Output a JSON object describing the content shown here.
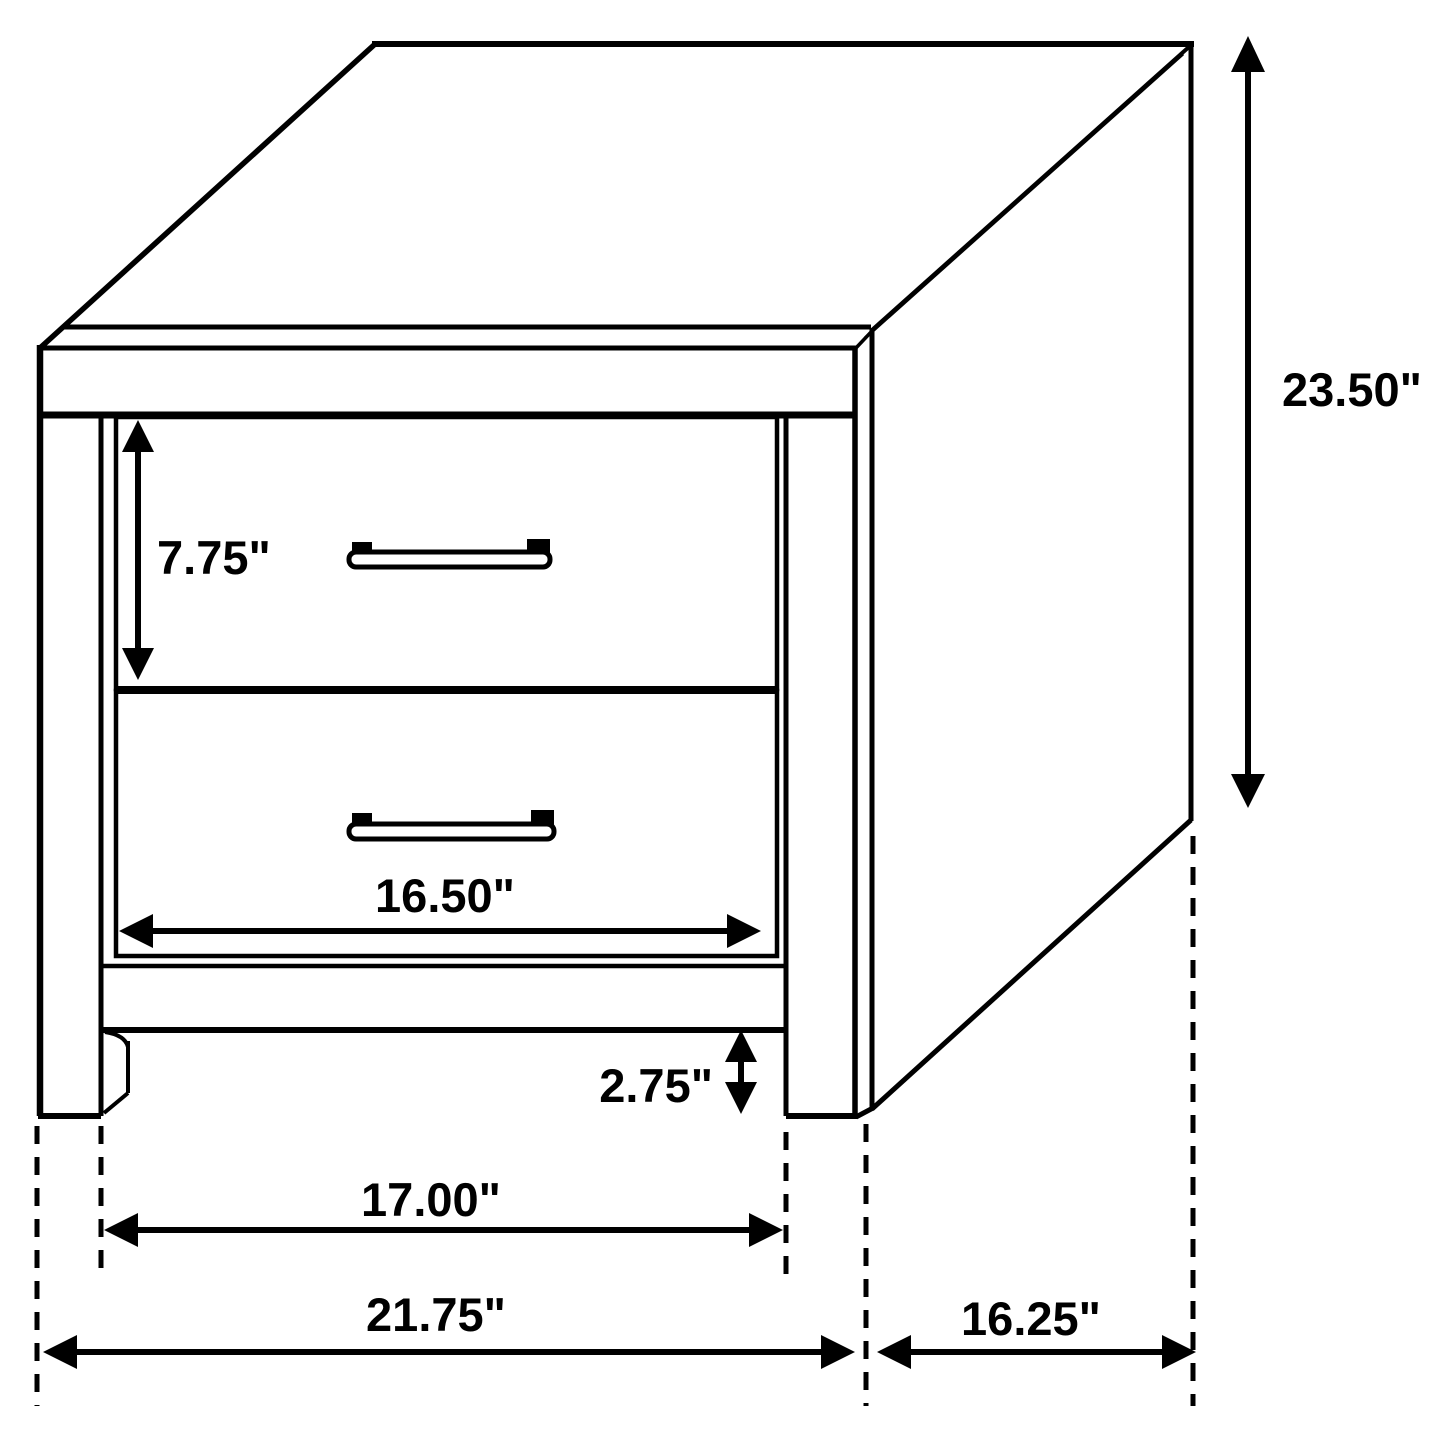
{
  "colors": {
    "line": "#000000",
    "background": "#ffffff",
    "label_text": "#000000"
  },
  "dimension_labels": {
    "drawer_height": "7.75\"",
    "overall_height": "23.50\"",
    "drawer_width": "16.50\"",
    "foot_clearance": "2.75\"",
    "inner_leg_width": "17.00\"",
    "overall_width": "21.75\"",
    "overall_depth": "16.25\""
  }
}
